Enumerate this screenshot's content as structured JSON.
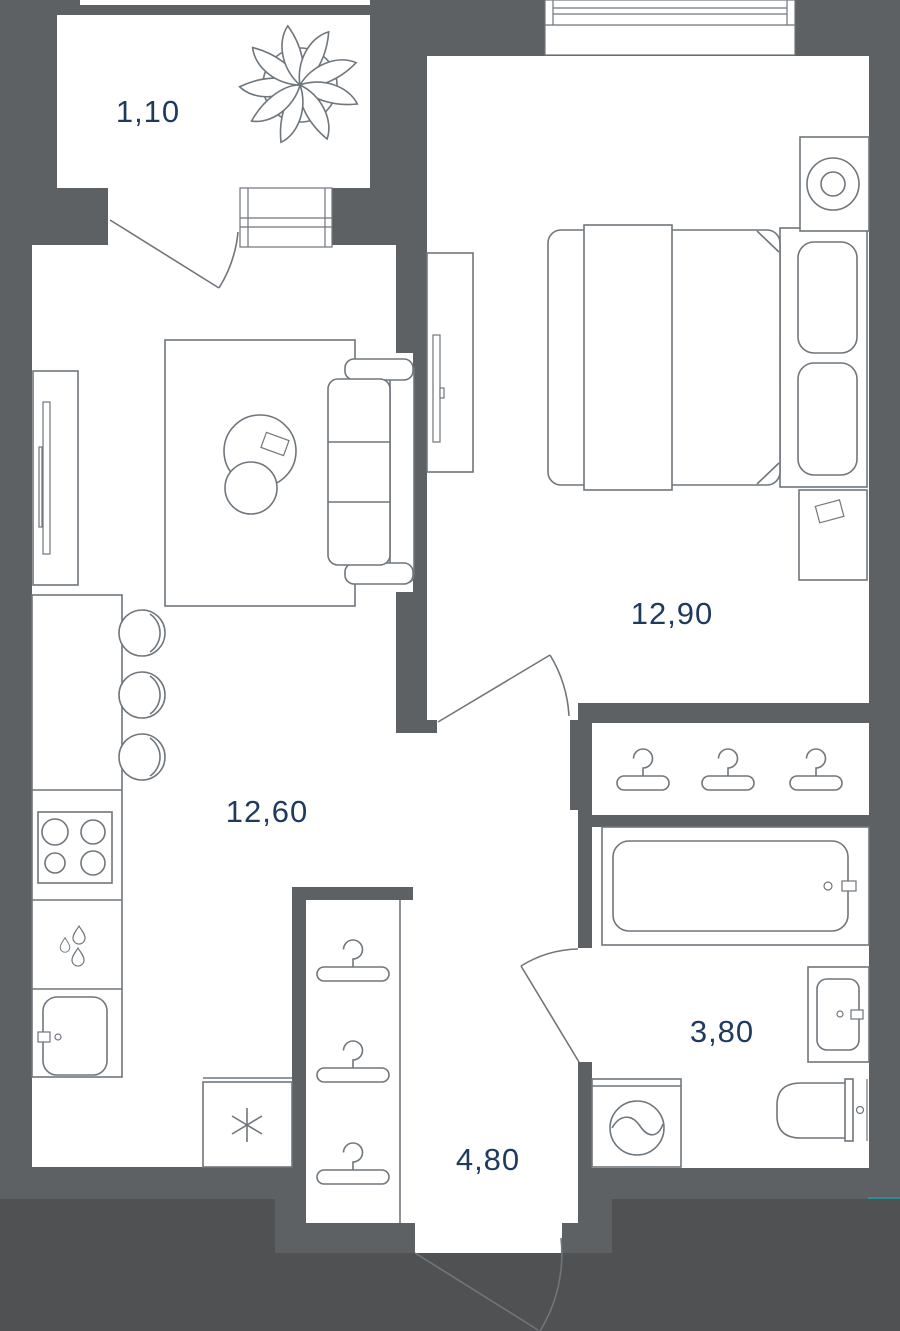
{
  "page": {
    "type": "apartment-floor-plan"
  },
  "rooms": [
    {
      "id": "balcony",
      "area": "1,10"
    },
    {
      "id": "bedroom",
      "area": "12,90"
    },
    {
      "id": "kitchen-living-room",
      "area": "12,60"
    },
    {
      "id": "bathroom",
      "area": "3,80"
    },
    {
      "id": "hallway",
      "area": "4,80"
    }
  ],
  "colors": {
    "wall": "#5d6164",
    "outside": "#4f5153",
    "room": "#ffffff",
    "line": "#6f767c",
    "label": "#1e3a5e",
    "artifact": "#2f8d95"
  },
  "furniture_icons": [
    "plant-icon",
    "balcony-door-swing-icon",
    "balcony-window-icon",
    "window-icon",
    "tv-stand-icon",
    "rug-icon",
    "coffee-tables-icon",
    "sofa-icon",
    "kitchen-counter-icon",
    "bar-stools-icon",
    "stove-icon",
    "dishwasher-icon",
    "kitchen-sink-icon",
    "fridge-icon",
    "wardrobe-hangers-icon",
    "closet-hangers-icon",
    "bedroom-door-swing-icon",
    "bathroom-door-swing-icon",
    "entrance-door-swing-icon",
    "bed-icon",
    "nightstand-icon",
    "floor-lamp-icon",
    "bathtub-icon",
    "washing-machine-icon",
    "toilet-icon",
    "vanity-sink-icon"
  ]
}
